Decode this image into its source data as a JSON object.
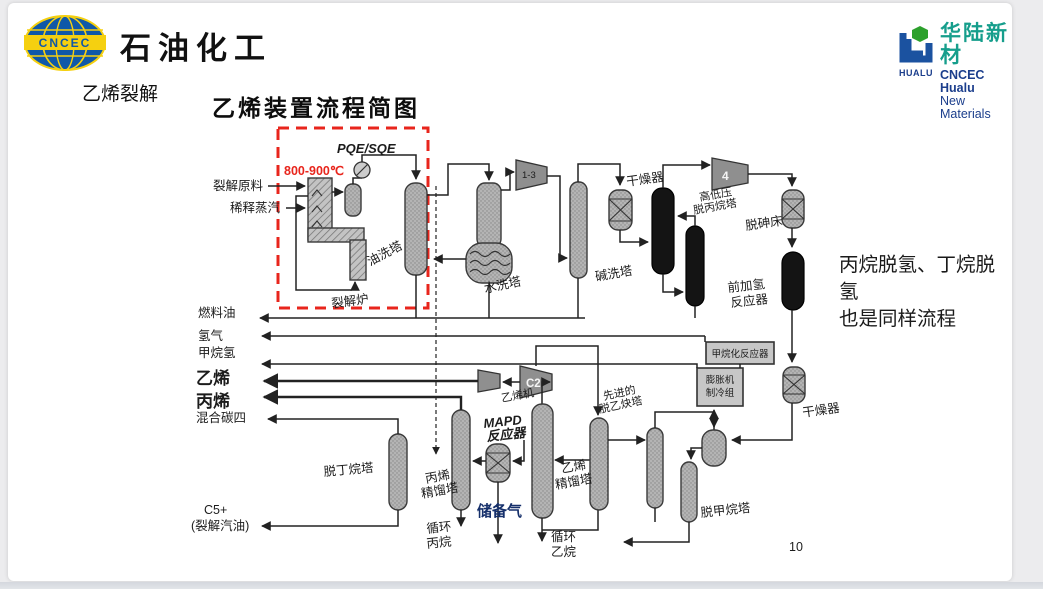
{
  "header": {
    "logo_badge": "CNCEC",
    "company": "石油化工",
    "hualu_cn": "华陆新材",
    "hualu_en1": "CNCEC Hualu",
    "hualu_en2": "New Materials",
    "hualu_badge": "HUALU"
  },
  "slide": {
    "section_title": "乙烯裂解",
    "diagram_title": "乙烯装置流程简图",
    "page_number": "10",
    "note_line1": "丙烷脱氢、丁烷脱氢",
    "note_line2": "也是同样流程"
  },
  "colors": {
    "accent_red": "#e8251c",
    "note_navy": "#16306b",
    "hualu_teal": "#169e8c",
    "logo_blue": "#0f58a8",
    "logo_yellow": "#f5d010"
  },
  "diagram": {
    "temp_note": "800-900℃",
    "pqe": "PQE/SQE",
    "feed": "裂解原料",
    "steam": "稀释蒸汽",
    "furnace": "裂解炉",
    "oil_wash": "油洗塔",
    "water_wash": "水洗塔",
    "caustic_wash": "碱洗塔",
    "dryer1": "干燥器",
    "comp13": "1-3",
    "comp4": "4",
    "comp_c2": "C2",
    "ethylene_comp": "乙烯机",
    "depropanizer_l1": "高低压",
    "depropanizer_l2": "脱丙烷塔",
    "dearsenic": "脱砷床",
    "front_hydro_l1": "前加氢",
    "front_hydro_l2": "反应器",
    "methanation": "甲烷化反应器",
    "expander_l1": "膨胀机",
    "expander_l2": "制冷组",
    "dryer2": "干燥器",
    "demethanizer": "脱甲烷塔",
    "deacetylene_l1": "先进的",
    "deacetylene_l2": "脱乙炔塔",
    "ethylene_col_l1": "乙烯",
    "ethylene_col_l2": "精馏塔",
    "recycle_ethane_l1": "循环",
    "recycle_ethane_l2": "乙烷",
    "propylene_col_l1": "丙烯",
    "propylene_col_l2": "精馏塔",
    "recycle_propane_l1": "循环",
    "recycle_propane_l2": "丙烷",
    "mapd_l1": "MAPD",
    "mapd_l2": "反应器",
    "reserve_gas": "储备气",
    "debutanizer": "脱丁烷塔",
    "products": {
      "fuel_oil": "燃料油",
      "hydrogen": "氢气",
      "methane_h": "甲烷氢",
      "ethylene": "乙烯",
      "propylene": "丙烯",
      "mixed_c4": "混合碳四",
      "c5": "C5+",
      "c5_sub": "(裂解汽油)"
    }
  }
}
